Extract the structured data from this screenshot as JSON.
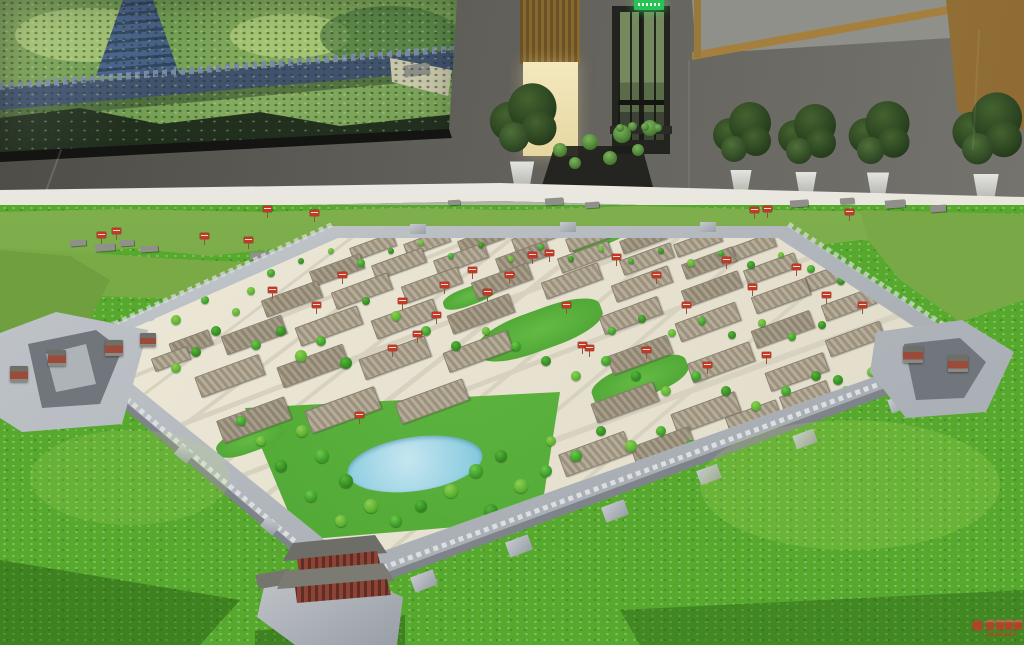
{
  "scene": {
    "colors": {
      "grass": "#57a92e",
      "model_ground": "#e9e3d2",
      "city_wall_grey": "#b3b8bd",
      "lake_blue": "#a5d6e8",
      "sign_red": "#c1392b",
      "exit_sign_green": "#27c455",
      "room_wall_grey": "#64625c",
      "wood_tan": "#a57f3e",
      "doorway_glow": "#f0e3b5",
      "screen_wall_blue": "#41526f",
      "watermark_red": "#c03a2b"
    }
  },
  "room": {
    "plants": [
      [
        522,
        196,
        1.15
      ],
      [
        741,
        200,
        1.0
      ],
      [
        806,
        202,
        1.0
      ],
      [
        878,
        204,
        1.05
      ],
      [
        986,
        210,
        1.2
      ]
    ],
    "stand_plants": [
      [
        560,
        150,
        14
      ],
      [
        590,
        142,
        16
      ],
      [
        622,
        134,
        18
      ],
      [
        650,
        128,
        16
      ],
      [
        575,
        163,
        12
      ],
      [
        610,
        158,
        14
      ],
      [
        638,
        150,
        12
      ],
      [
        620,
        128,
        8
      ],
      [
        632,
        126,
        9
      ],
      [
        645,
        127,
        8
      ],
      [
        658,
        128,
        8
      ]
    ]
  },
  "model": {
    "trees": [
      [
        150,
        315,
        5
      ],
      [
        162,
        301,
        4
      ],
      [
        176,
        320,
        5
      ],
      [
        205,
        300,
        4
      ],
      [
        216,
        331,
        5
      ],
      [
        236,
        312,
        4
      ],
      [
        256,
        345,
        5
      ],
      [
        281,
        331,
        5
      ],
      [
        301,
        356,
        6
      ],
      [
        321,
        341,
        5
      ],
      [
        346,
        363,
        6
      ],
      [
        251,
        291,
        4
      ],
      [
        271,
        273,
        4
      ],
      [
        301,
        261,
        3
      ],
      [
        331,
        251,
        3
      ],
      [
        361,
        263,
        4
      ],
      [
        391,
        251,
        3
      ],
      [
        421,
        243,
        3
      ],
      [
        451,
        256,
        3
      ],
      [
        481,
        245,
        3
      ],
      [
        511,
        259,
        3
      ],
      [
        541,
        247,
        3
      ],
      [
        571,
        259,
        3
      ],
      [
        601,
        249,
        3
      ],
      [
        631,
        261,
        3
      ],
      [
        661,
        251,
        3
      ],
      [
        691,
        263,
        4
      ],
      [
        721,
        253,
        3
      ],
      [
        751,
        265,
        4
      ],
      [
        781,
        255,
        3
      ],
      [
        811,
        269,
        4
      ],
      [
        841,
        281,
        4
      ],
      [
        871,
        293,
        4
      ],
      [
        901,
        306,
        4
      ],
      [
        366,
        301,
        4
      ],
      [
        396,
        316,
        5
      ],
      [
        426,
        331,
        5
      ],
      [
        456,
        346,
        5
      ],
      [
        486,
        331,
        4
      ],
      [
        516,
        346,
        5
      ],
      [
        546,
        361,
        5
      ],
      [
        576,
        376,
        5
      ],
      [
        606,
        361,
        5
      ],
      [
        636,
        376,
        5
      ],
      [
        666,
        391,
        5
      ],
      [
        696,
        376,
        5
      ],
      [
        726,
        391,
        5
      ],
      [
        756,
        406,
        5
      ],
      [
        786,
        391,
        5
      ],
      [
        816,
        376,
        5
      ],
      [
        846,
        391,
        5
      ],
      [
        612,
        331,
        4
      ],
      [
        642,
        319,
        4
      ],
      [
        672,
        333,
        4
      ],
      [
        702,
        321,
        4
      ],
      [
        732,
        335,
        4
      ],
      [
        762,
        323,
        4
      ],
      [
        792,
        337,
        4
      ],
      [
        822,
        325,
        4
      ],
      [
        302,
        431,
        6
      ],
      [
        322,
        456,
        7
      ],
      [
        346,
        481,
        7
      ],
      [
        371,
        506,
        7
      ],
      [
        396,
        521,
        6
      ],
      [
        421,
        506,
        6
      ],
      [
        451,
        491,
        7
      ],
      [
        476,
        471,
        7
      ],
      [
        501,
        456,
        6
      ],
      [
        521,
        486,
        7
      ],
      [
        546,
        471,
        6
      ],
      [
        491,
        511,
        7
      ],
      [
        341,
        521,
        6
      ],
      [
        311,
        496,
        6
      ],
      [
        281,
        466,
        6
      ],
      [
        551,
        441,
        5
      ],
      [
        576,
        456,
        6
      ],
      [
        601,
        431,
        5
      ],
      [
        631,
        446,
        6
      ],
      [
        661,
        431,
        5
      ],
      [
        691,
        446,
        6
      ],
      [
        261,
        441,
        5
      ],
      [
        241,
        421,
        5
      ],
      [
        838,
        380,
        5
      ],
      [
        872,
        372,
        5
      ],
      [
        902,
        362,
        4
      ],
      [
        196,
        352,
        5
      ],
      [
        176,
        368,
        5
      ]
    ],
    "city_signs": [
      [
        170,
        292
      ],
      [
        148,
        305
      ],
      [
        196,
        272
      ],
      [
        243,
        257
      ],
      [
        268,
        287
      ],
      [
        312,
        302
      ],
      [
        338,
        272
      ],
      [
        398,
        298
      ],
      [
        413,
        331
      ],
      [
        432,
        312
      ],
      [
        388,
        345
      ],
      [
        468,
        267
      ],
      [
        483,
        289
      ],
      [
        528,
        252
      ],
      [
        562,
        302
      ],
      [
        578,
        342
      ],
      [
        612,
        254
      ],
      [
        652,
        272
      ],
      [
        682,
        302
      ],
      [
        722,
        257
      ],
      [
        748,
        284
      ],
      [
        792,
        264
      ],
      [
        822,
        292
      ],
      [
        858,
        302
      ],
      [
        642,
        347
      ],
      [
        703,
        362
      ],
      [
        762,
        352
      ],
      [
        355,
        412
      ],
      [
        585,
        345
      ],
      [
        545,
        250
      ],
      [
        440,
        282
      ],
      [
        505,
        272
      ]
    ],
    "hill_signs": [
      [
        112,
        228
      ],
      [
        200,
        233
      ],
      [
        244,
        237
      ],
      [
        263,
        206
      ],
      [
        310,
        210
      ],
      [
        845,
        209
      ],
      [
        750,
        207
      ],
      [
        763,
        206
      ],
      [
        97,
        232
      ]
    ],
    "blocks": [
      [
        350,
        240,
        44,
        12
      ],
      [
        404,
        236,
        44,
        12
      ],
      [
        458,
        233,
        44,
        12
      ],
      [
        512,
        231,
        44,
        12
      ],
      [
        566,
        231,
        44,
        12
      ],
      [
        620,
        233,
        44,
        12
      ],
      [
        674,
        236,
        46,
        12
      ],
      [
        728,
        240,
        46,
        13
      ],
      [
        310,
        262,
        52,
        14
      ],
      [
        372,
        256,
        52,
        14
      ],
      [
        434,
        251,
        52,
        14
      ],
      [
        496,
        249,
        52,
        14
      ],
      [
        558,
        249,
        52,
        14
      ],
      [
        620,
        251,
        52,
        14
      ],
      [
        682,
        255,
        52,
        14
      ],
      [
        744,
        261,
        52,
        14
      ],
      [
        806,
        268,
        48,
        14
      ],
      [
        262,
        290,
        58,
        16
      ],
      [
        332,
        282,
        58,
        16
      ],
      [
        402,
        276,
        58,
        16
      ],
      [
        472,
        272,
        58,
        16
      ],
      [
        542,
        272,
        58,
        16
      ],
      [
        612,
        275,
        58,
        16
      ],
      [
        682,
        280,
        58,
        16
      ],
      [
        752,
        287,
        56,
        16
      ],
      [
        822,
        296,
        52,
        15
      ],
      [
        222,
        325,
        62,
        18
      ],
      [
        296,
        316,
        64,
        18
      ],
      [
        372,
        309,
        64,
        18
      ],
      [
        448,
        304,
        64,
        18
      ],
      [
        600,
        306,
        60,
        17
      ],
      [
        676,
        312,
        62,
        18
      ],
      [
        752,
        320,
        60,
        17
      ],
      [
        826,
        330,
        56,
        16
      ],
      [
        196,
        365,
        66,
        20
      ],
      [
        278,
        355,
        68,
        20
      ],
      [
        360,
        347,
        68,
        20
      ],
      [
        444,
        341,
        66,
        19
      ],
      [
        608,
        345,
        62,
        18
      ],
      [
        688,
        352,
        64,
        19
      ],
      [
        766,
        362,
        60,
        18
      ],
      [
        218,
        408,
        70,
        22
      ],
      [
        306,
        398,
        72,
        22
      ],
      [
        396,
        390,
        70,
        21
      ],
      [
        592,
        392,
        64,
        19
      ],
      [
        672,
        402,
        66,
        20
      ],
      [
        560,
        442,
        68,
        22
      ],
      [
        632,
        436,
        60,
        20
      ],
      [
        726,
        408,
        52,
        15
      ],
      [
        780,
        388,
        48,
        14
      ],
      [
        170,
        336,
        40,
        14
      ],
      [
        152,
        352,
        36,
        12
      ]
    ],
    "streets": [
      [
        60,
        345,
        1000,
        -22,
        4
      ],
      [
        95,
        390,
        1000,
        -22,
        4
      ],
      [
        135,
        440,
        1000,
        -21,
        5
      ],
      [
        185,
        495,
        1000,
        -21,
        5
      ],
      [
        245,
        550,
        1000,
        -20,
        6
      ],
      [
        40,
        310,
        1000,
        -23,
        3
      ],
      [
        360,
        230,
        470,
        143,
        3
      ],
      [
        440,
        230,
        480,
        143,
        4
      ],
      [
        520,
        230,
        490,
        142,
        4
      ],
      [
        600,
        232,
        500,
        142,
        5
      ],
      [
        680,
        234,
        500,
        141,
        4
      ],
      [
        760,
        238,
        480,
        140,
        4
      ],
      [
        845,
        260,
        420,
        140,
        4
      ]
    ],
    "parks": [
      [
        540,
        330,
        130,
        40
      ],
      [
        640,
        380,
        100,
        34
      ],
      [
        600,
        240,
        60,
        12
      ],
      [
        250,
        440,
        70,
        24
      ],
      [
        470,
        296,
        56,
        18
      ]
    ],
    "bastions": [
      [
        889,
        396,
        22,
        14,
        -20
      ],
      [
        794,
        432,
        22,
        14,
        -20
      ],
      [
        698,
        467,
        22,
        15,
        -20
      ],
      [
        603,
        503,
        24,
        16,
        -20
      ],
      [
        507,
        538,
        24,
        16,
        -20
      ],
      [
        412,
        573,
        24,
        16,
        -20
      ],
      [
        262,
        520,
        16,
        12,
        40
      ],
      [
        176,
        448,
        16,
        12,
        40
      ],
      [
        410,
        224,
        16,
        10,
        0
      ],
      [
        560,
        222,
        16,
        10,
        0
      ],
      [
        700,
        222,
        16,
        10,
        0
      ]
    ],
    "ruins": [
      [
        70,
        240,
        16,
        6
      ],
      [
        95,
        244,
        20,
        7
      ],
      [
        120,
        240,
        14,
        6
      ],
      [
        140,
        246,
        18,
        6
      ],
      [
        250,
        252,
        22,
        7
      ],
      [
        285,
        248,
        16,
        6
      ],
      [
        310,
        254,
        18,
        6
      ],
      [
        790,
        200,
        18,
        7
      ],
      [
        840,
        198,
        14,
        6
      ],
      [
        885,
        200,
        20,
        8
      ],
      [
        930,
        205,
        16,
        7
      ],
      [
        545,
        198,
        18,
        7
      ],
      [
        585,
        202,
        14,
        6
      ],
      [
        448,
        200,
        12,
        5
      ]
    ],
    "mini_towers": [
      [
        10,
        366,
        18,
        16
      ],
      [
        48,
        350,
        18,
        16
      ],
      [
        105,
        340,
        18,
        16
      ],
      [
        140,
        333,
        16,
        14
      ],
      [
        903,
        346,
        20,
        17
      ],
      [
        948,
        355,
        20,
        17
      ]
    ]
  }
}
